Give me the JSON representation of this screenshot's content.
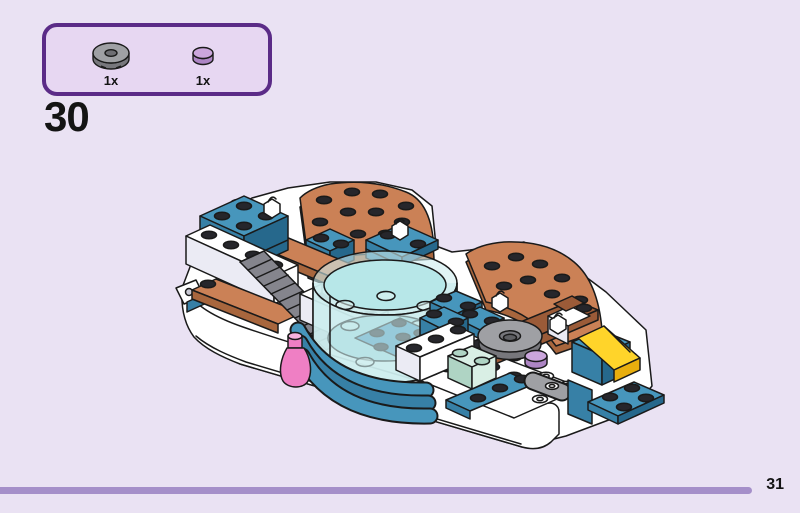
{
  "palette": {
    "background": "#EAE2F3",
    "panel-fill": "#E7D7F2",
    "panel-border": "#5B2B87",
    "ink": "#141414",
    "footer-line": "#A58FC9",
    "outline": "#1A1A1A",
    "white": "#FFFFFF",
    "white-shade": "#EBEBF4",
    "tan-top": "#CB8156",
    "tan-dark": "#A8663D",
    "brown": "#9B5B38",
    "teal-top": "#4796BC",
    "teal-front": "#3780A6",
    "teal-dark": "#26688C",
    "mint": "#D9EFE5",
    "mint-dark": "#AFD4C4",
    "yellow": "#FFD42A",
    "yellow-light": "#FFE45C",
    "yellow-dark": "#E8AE0E",
    "pink": "#EF7FC4",
    "pink-light": "#F7B2DE",
    "gray": "#9FA0A4",
    "gray-dark": "#77777C",
    "lavender": "#CBA6DC",
    "lavender-dark": "#AD85C4",
    "trans-blue": "#CDEDEF",
    "trans-inner": "#B7E7E8",
    "trans-floor": "#9ED8DB",
    "grille-base": "#85858D",
    "grille-stripe": "#3A3A40",
    "stud": "#26262B"
  },
  "parts_panel": {
    "parts": [
      {
        "id": "turntable-plate-2x2-gray",
        "label": "1x",
        "color": "#9FA0A4"
      },
      {
        "id": "round-plate-1x1-lavender",
        "label": "1x",
        "color": "#CBA6DC"
      }
    ]
  },
  "step": {
    "number": "30"
  },
  "footer": {
    "page_number": "31"
  },
  "illustration": {
    "description": "Isometric view of a partially built LEGO boat: white hull with curved bow, dark-gray grille ramp, tan curved quarter deck plates, teal bricks and plates with white clips, a large transparent light-blue round tub with a teal plate inside, mint and white bricks, a trans-pink bottle, a yellow round brick, and at right a gray 2x2 turntable plate with a lavender 1x1 round plate beside a yellow double slope on a teal side bracket."
  }
}
